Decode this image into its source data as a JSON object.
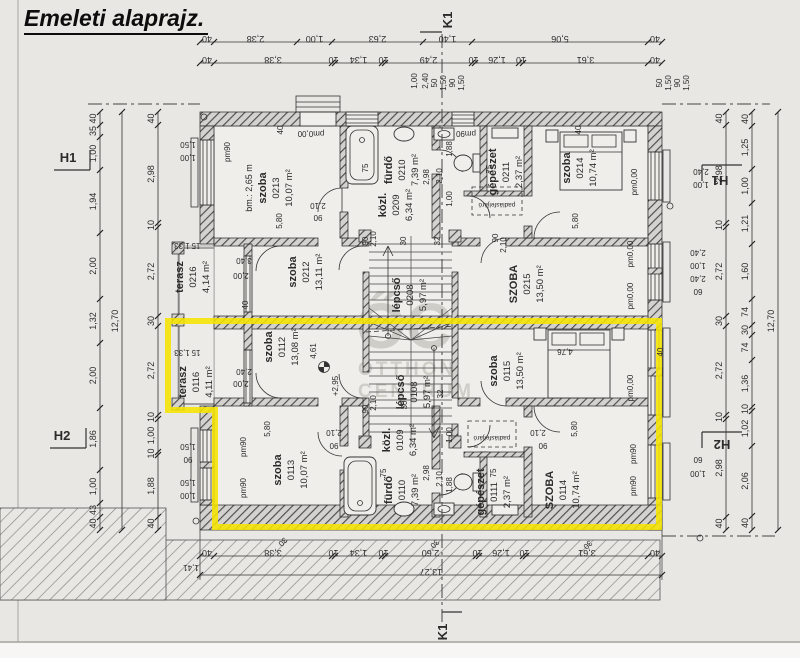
{
  "title": "Emeleti alaprajz.",
  "axis": {
    "k1": "K1",
    "h1": "H1",
    "h2": "H2"
  },
  "watermark": {
    "logo": "ŐC",
    "line1": "OTTHON",
    "line2": "CENTRUM"
  },
  "rooms": [
    {
      "name": "szoba",
      "number": "0213",
      "area": "10,07 m²",
      "extra": "bm.: 2,65 m"
    },
    {
      "name": "fürdő",
      "number": "0210",
      "area": "7,39 m²"
    },
    {
      "name": "közl.",
      "number": "0209",
      "area": "6,34 m²"
    },
    {
      "name": "lépcső",
      "number": "0208",
      "area": "5,97 m²"
    },
    {
      "name": "gépészet",
      "number": "0211",
      "area": "2,37 m²"
    },
    {
      "name": "szoba",
      "number": "0214",
      "area": "10,74 m²"
    },
    {
      "name": "SZOBA",
      "number": "0215",
      "area": "13,50 m²"
    },
    {
      "name": "terasz",
      "number": "0216",
      "area": "4,14 m²"
    },
    {
      "name": "szoba",
      "number": "0212",
      "area": "13,11 m²"
    },
    {
      "name": "terasz",
      "number": "0116",
      "area": "4,11 m²"
    },
    {
      "name": "szoba",
      "number": "0112",
      "area": "13,08 m²"
    },
    {
      "name": "szoba",
      "number": "0113",
      "area": "10,07 m²"
    },
    {
      "name": "fürdő",
      "number": "0110",
      "area": "7,39 m²"
    },
    {
      "name": "közl.",
      "number": "0109",
      "area": "6,34 m²"
    },
    {
      "name": "lépcső",
      "number": "0108",
      "area": "5,97 m²"
    },
    {
      "name": "gépészet",
      "number": "0111",
      "area": "2,37 m²"
    },
    {
      "name": "SZOBA",
      "number": "0114",
      "area": "10,74 m²"
    },
    {
      "name": "szoba",
      "number": "0115",
      "area": "13,50 m²"
    }
  ],
  "dims": {
    "top_outer": [
      "40",
      "2,38",
      "1,00",
      "2,63",
      "1,40",
      "5,06",
      "40"
    ],
    "top_inner": [
      "40",
      "3,38",
      "10",
      "1,34",
      "10",
      "2,49",
      "10",
      "1,26",
      "10",
      "3,61",
      "40"
    ],
    "bottom_inner": [
      "40",
      "3,38",
      "10",
      "1,34",
      "10",
      "2,60",
      "10",
      "1,26",
      "10",
      "3,61",
      "40"
    ],
    "bottom_overall": [
      "13,27"
    ],
    "left_outer": [
      "40",
      "35",
      "1,00",
      "1,94",
      "2,00",
      "1,32",
      "2,00",
      "1,86",
      "1,00",
      "43",
      "40"
    ],
    "left_inner": [
      "40",
      "2,98",
      "10",
      "2,72",
      "30",
      "2,72",
      "10",
      "1,00",
      "10",
      "1,88",
      "40"
    ],
    "left_overall": [
      "12,70"
    ],
    "right_inner": [
      "40",
      "2,98",
      "10",
      "2,72",
      "30",
      "2,72",
      "10",
      "2,98",
      "40"
    ],
    "right_outer": [
      "40",
      "1,25",
      "1,00",
      "1,21",
      "1,60",
      "74",
      "30",
      "74",
      "1,36",
      "10",
      "1,02",
      "2,06",
      "40"
    ],
    "right_overall": [
      "12,70"
    ]
  },
  "annotations": [
    "pm90",
    "pm0,00",
    "pm90",
    "pm0,00",
    "pm0,00",
    "pm0,00",
    "pm0,00",
    "pm90",
    "pm90",
    "pm90",
    "pm90",
    "+2,95",
    "4,76",
    "4,61",
    "5,80",
    "5,80",
    "5,80",
    "5,80",
    "3,40",
    "2,00",
    "2,40",
    "2,00",
    "2,10",
    "90",
    "2,10",
    "90",
    "2,10",
    "90",
    "2,10",
    "90",
    "2,10",
    "90",
    "2,10",
    "90",
    "1,88",
    "1,00",
    "2,98",
    "2,10",
    "1,88",
    "1,00",
    "2,98",
    "2,10",
    "padlásfeljáró",
    "padlásfeljáró",
    "75",
    "75",
    "75",
    "75",
    "40",
    "40",
    "40",
    "40",
    "30",
    "30",
    "30",
    "1,41",
    "1,00",
    "2,40",
    "50",
    "1,50",
    "90",
    "1,50",
    "50",
    "1,50",
    "90",
    "1,50",
    "2,40",
    "1,00",
    "2,40",
    "1,00",
    "2,40",
    "60",
    "60",
    "1,00",
    "1,50",
    "1,00",
    "1,50",
    "90",
    "1,50",
    "1,00",
    "32",
    "32",
    "30",
    "30",
    "1,33",
    "15",
    "1,33",
    "15"
  ],
  "colors": {
    "highlight": "#f5e400",
    "paper": "#e9e7e3",
    "ink": "#2b2b2b"
  }
}
